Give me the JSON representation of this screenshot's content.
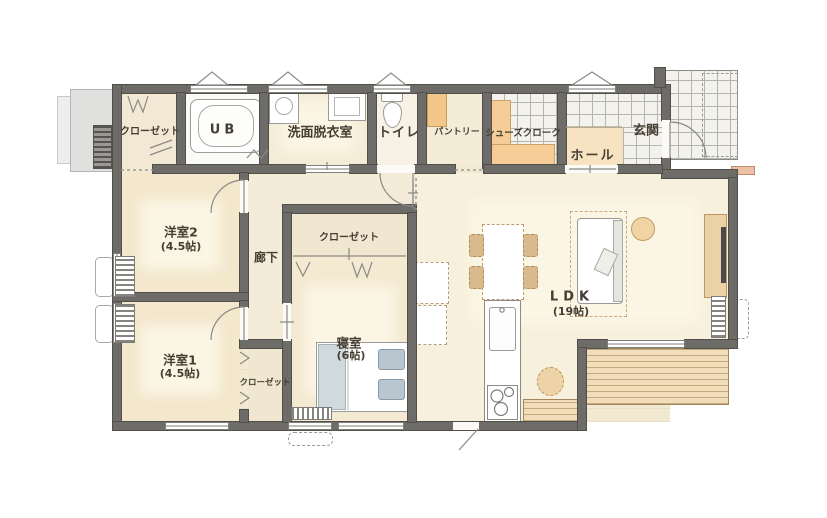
{
  "rooms": {
    "closet_top": {
      "label": "クローゼット"
    },
    "ub": {
      "label": "UB"
    },
    "washroom": {
      "label": "洗面脱衣室"
    },
    "toilet": {
      "label": "トイレ"
    },
    "pantry": {
      "label": "パントリー"
    },
    "shoe_closet": {
      "label": "シューズクローク"
    },
    "hall": {
      "label": "ホール"
    },
    "entrance": {
      "label": "玄関"
    },
    "western2": {
      "label": "洋室2",
      "size": "(4.5帖)"
    },
    "corridor": {
      "label": "廊下"
    },
    "bedroom_closet": {
      "label": "クローゼット"
    },
    "bedroom": {
      "label": "寝室",
      "size": "(6帖)"
    },
    "ldk": {
      "label": "LDK",
      "size": "(19帖)"
    },
    "western1": {
      "label": "洋室1",
      "size": "(4.5帖)"
    },
    "western1_closet": {
      "label": "クローゼット"
    }
  },
  "fixtures": [
    "bathtub",
    "washing-machine",
    "washbasin",
    "toilet-bowl",
    "pantry-shelf",
    "shoe-bench",
    "refrigerator",
    "cupboard",
    "dining-table",
    "dining-chair",
    "kitchen-counter",
    "sink",
    "cooktop",
    "counter-chair",
    "sofa",
    "round-table",
    "tv-board",
    "tv",
    "bed",
    "pillow",
    "air-conditioner",
    "outdoor-unit",
    "wood-deck",
    "entrance-porch",
    "entrance-step",
    "concrete-pad"
  ],
  "colors": {
    "wall": "#6e6c68",
    "wood_floor": "#f2e9d2",
    "ldk_floor": "#f7f0dc",
    "hall_floor": "#f7e3c1",
    "tile": "#f4f2ec",
    "deck": "#f1ddba",
    "bench_orange": "#f6cd96",
    "bed_blue": "#b9c6cf",
    "furniture_tan": "#d9b98e"
  }
}
